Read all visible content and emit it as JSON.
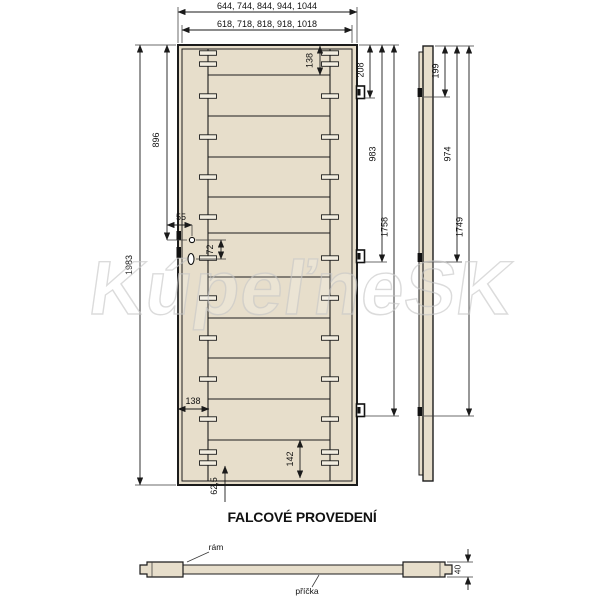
{
  "title": "FALCOVÉ PROVEDENÍ",
  "watermark": "KúpeľneSK",
  "front_view": {
    "outer_width_options": "644, 744, 844, 944, 1044",
    "inner_width_options": "618, 718, 818, 918, 1018",
    "height": "1983",
    "top_rail": "138",
    "lock_center_from_top": "896",
    "lock_backset": "55",
    "lock_hole_spacing": "72",
    "stile_width": "138",
    "bottom_rail": "142",
    "bottom_dowel_offset": "62,5",
    "hinge_top": "208",
    "hinge_middle": "983",
    "hinge_bottom": "1758"
  },
  "side_view": {
    "hinge_top": "199",
    "hinge_middle": "974",
    "hinge_bottom": "1749"
  },
  "section": {
    "frame_label": "rám",
    "crossbar_label": "příčka",
    "thickness": "40"
  },
  "colors": {
    "wood": "#e7decb",
    "line": "#1c1c1c",
    "watermark": "#c9c9c9"
  }
}
